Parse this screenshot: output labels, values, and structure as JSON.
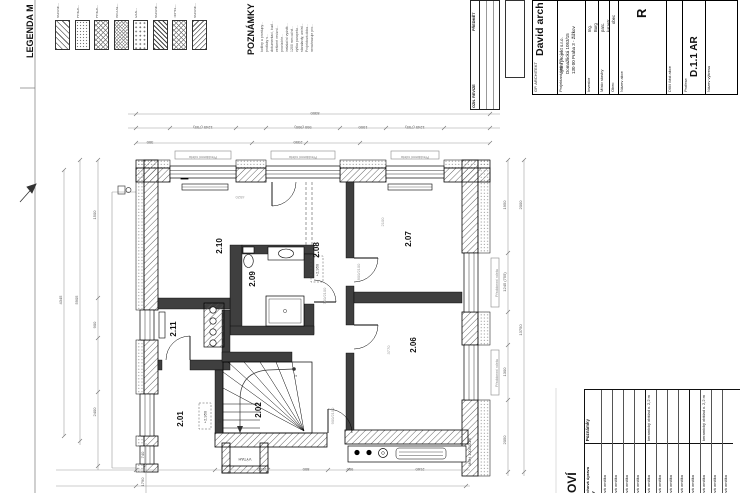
{
  "legend": {
    "title": "LEGENDA M",
    "items": [
      {
        "label": "NOSNÉ..."
      },
      {
        "label": "PŘÍČK..."
      },
      {
        "label": "PŘÍČK..."
      },
      {
        "label": "INSTAL..."
      },
      {
        "label": "IZOL..."
      },
      {
        "label": "NOSNÉ..."
      },
      {
        "label": "TEPEL..."
      },
      {
        "label": "NOSNÉ..."
      }
    ]
  },
  "notes": {
    "title": "POZNÁMKY",
    "lines": [
      "kotliny a prostupy...",
      "protlaky s...",
      "dokumentaci, bud...",
      "veškeré revizní...",
      "provizórie...",
      "instalační vyústk...",
      "1200 mm od st...",
      "výška parapetu...",
      "standardy, umíst...",
      "Projektová doku...",
      "nenahrazuje pro..."
    ]
  },
  "revision_table": {
    "header_left": "OZN. REVIZE",
    "header_right": "PŘEDMĚT"
  },
  "title_block": {
    "architect_label": "GP. ARCHITEKT",
    "architect": "David arch",
    "designer_label": "Projektant část PD",
    "designer_lines": [
      "optim projekt s.r.o.",
      "Domažlická 1053/15",
      "130 00 Praha 3 - Žižkov"
    ],
    "investor_label": "Investor",
    "investor_lines": [
      "Ing.",
      "Burg"
    ],
    "site_label": "Místo stavby",
    "site_lines": [
      "parc.",
      "katastr."
    ],
    "municipality_label": "Obec",
    "municipality": "obec",
    "project_label": "Název akce",
    "project": "R",
    "part_label": "Dílčí část akce",
    "part": "",
    "profession_label": "Profese",
    "profession": "D.1.1 AR",
    "drawing_label": "Název výkresu",
    "drawing": ""
  },
  "plan": {
    "rooms": [
      {
        "id": "2.01"
      },
      {
        "id": "2.02"
      },
      {
        "id": "2.06"
      },
      {
        "id": "2.07"
      },
      {
        "id": "2.08"
      },
      {
        "id": "2.09"
      },
      {
        "id": "2.10"
      },
      {
        "id": "2.11"
      }
    ],
    "levels": {
      "hall": "+2,950",
      "corridor": "+2,950"
    },
    "stairs": {
      "first": "1",
      "last": "17"
    },
    "elevator_label": "VÝTAH",
    "annotations": {
      "shutter": "Předokenní roleta",
      "beam": "MSH 100/100/6"
    },
    "dims": {
      "top": [
        "8300",
        "1245 (755)",
        "950 (900)",
        "1000",
        "2350",
        "1245 (755)",
        "300"
      ],
      "left": [
        "5905",
        "4345",
        "1500",
        "900",
        "2400"
      ],
      "right": [
        "1950",
        "1245 (755)",
        "1300",
        "2050",
        "2000",
        "13750"
      ],
      "bottom": [
        "2150",
        "800",
        "900",
        "2160",
        "740",
        "1790"
      ],
      "interior": [
        "4520",
        "2100",
        "3770",
        "800/2100",
        "700/2100",
        "900/2100"
      ]
    }
  },
  "finishes_table": {
    "heading": "OVÍ",
    "col_surface_lines": [
      "Povrchová úprava",
      "stěny"
    ],
    "col_notes": "Poznámky",
    "rows": [
      {
        "surface": "štuková omítka",
        "note": ""
      },
      {
        "surface": "štuková omítka",
        "note": ""
      },
      {
        "surface": "štuková omítka",
        "note": ""
      },
      {
        "surface": "štuková omítka",
        "note": ""
      },
      {
        "surface": "štuková omítka",
        "note": "keramický obklad v. 2,2 m",
        "cls": "grp"
      },
      {
        "surface": "štuková omítka",
        "note": ""
      },
      {
        "surface": "štuková omítka",
        "note": ""
      },
      {
        "surface": "štuková omítka",
        "note": ""
      },
      {
        "surface": "štuková omítka",
        "note": "",
        "cls": "grp"
      },
      {
        "surface": "štuková omítka",
        "note": "keramický obklad v. 2,2 m"
      },
      {
        "surface": "štuková omítka",
        "note": ""
      },
      {
        "surface": "štuková omítka",
        "note": ""
      }
    ]
  }
}
